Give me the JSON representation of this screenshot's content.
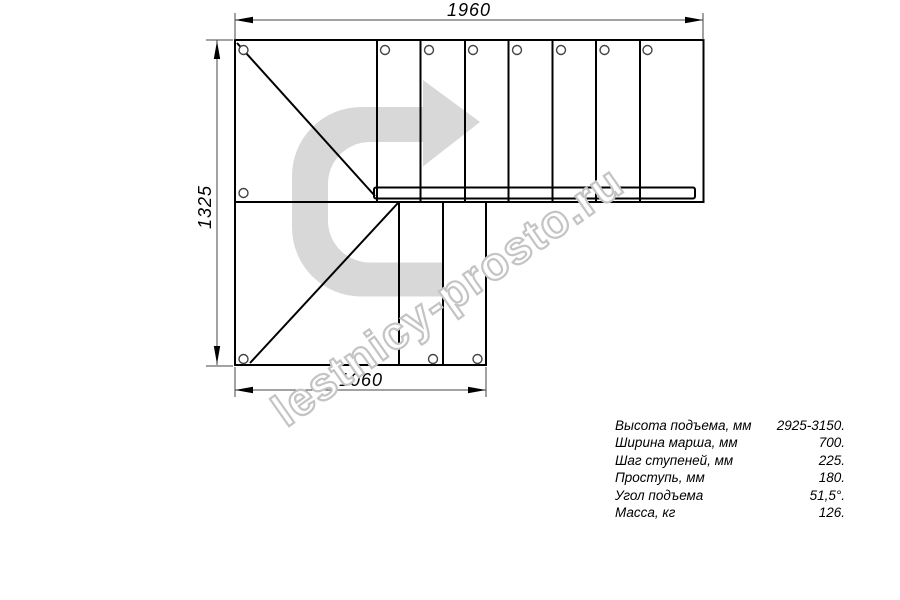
{
  "dimensions": {
    "top": "1960",
    "left": "1325",
    "bottom": "1060"
  },
  "arrow": {
    "color": "#d8d8d8"
  },
  "watermark": {
    "text": "lestnicy-prosto.ru",
    "outline_color": "#c4c4c4"
  },
  "specs": {
    "rows": [
      {
        "label": "Высота подъема, мм",
        "value": "2925-3150."
      },
      {
        "label": "Ширина марша, мм",
        "value": "700."
      },
      {
        "label": "Шаг ступеней, мм",
        "value": "225."
      },
      {
        "label": "Проступь, мм",
        "value": "180."
      },
      {
        "label": "Угол подъема",
        "value": "51,5°."
      },
      {
        "label": "Масса, кг",
        "value": "126."
      }
    ]
  }
}
